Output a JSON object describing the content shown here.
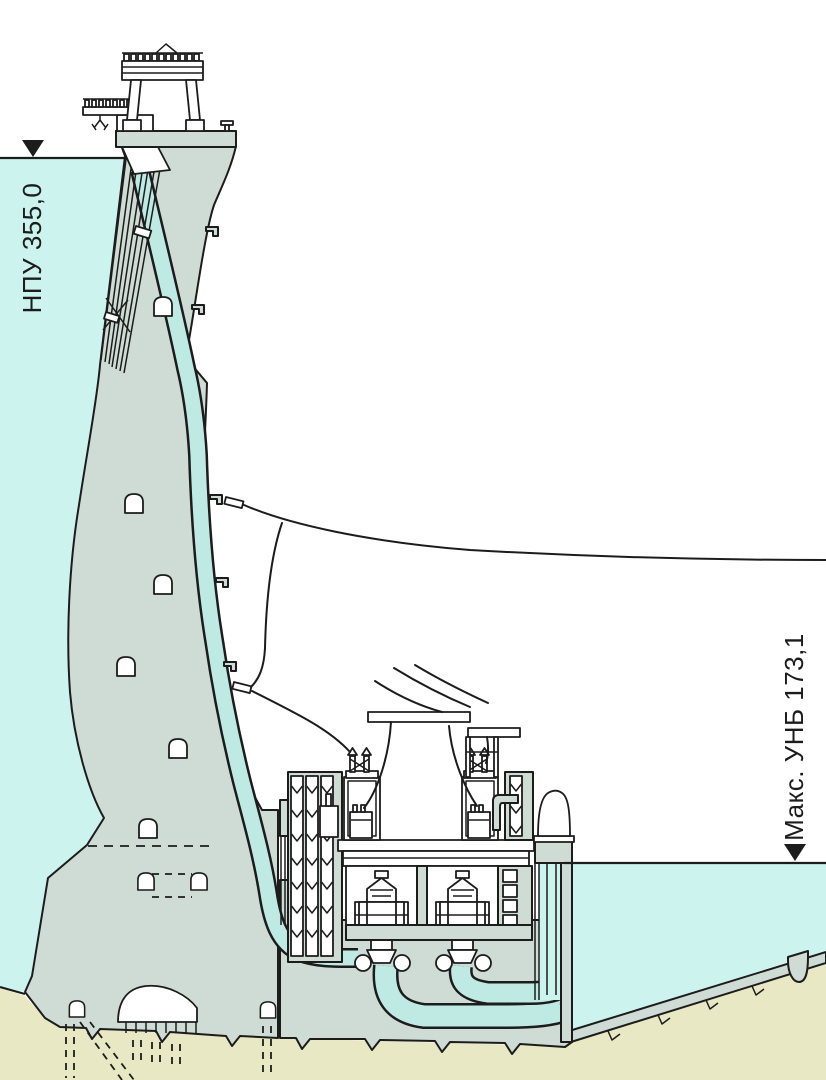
{
  "diagram": {
    "type": "hydroelectric-dam-cross-section",
    "labels": {
      "upstream_level": "НПУ 355,0",
      "downstream_level": "Макс. УНБ 173,1"
    },
    "icons": {
      "upstream_marker": "water-level-triangle-icon",
      "downstream_marker": "water-level-triangle-icon"
    },
    "colors": {
      "water": "#cdf3ee",
      "conduit": "#bfeae4",
      "concrete": "#cfdcd6",
      "bedrock": "#e9e8c4",
      "outline": "#1c1c1c",
      "machinery": "#ffffff",
      "background": "#ffffff"
    }
  }
}
